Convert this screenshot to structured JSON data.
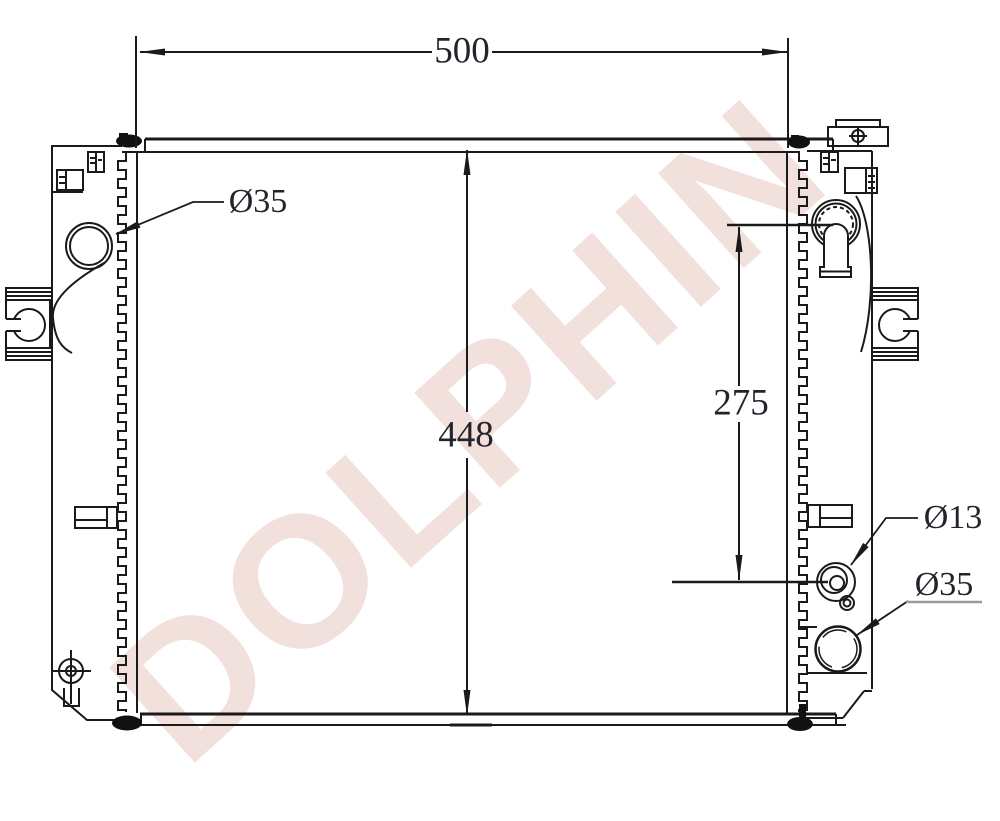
{
  "watermark": {
    "text": "DOLPHIN"
  },
  "dimensions": {
    "overall_width": "500",
    "overall_height": "448",
    "port_spacing": "275"
  },
  "port_labels": {
    "left_inlet_diameter": "Ø35",
    "right_drain_diameter": "Ø13",
    "right_outlet_diameter": "Ø35"
  }
}
